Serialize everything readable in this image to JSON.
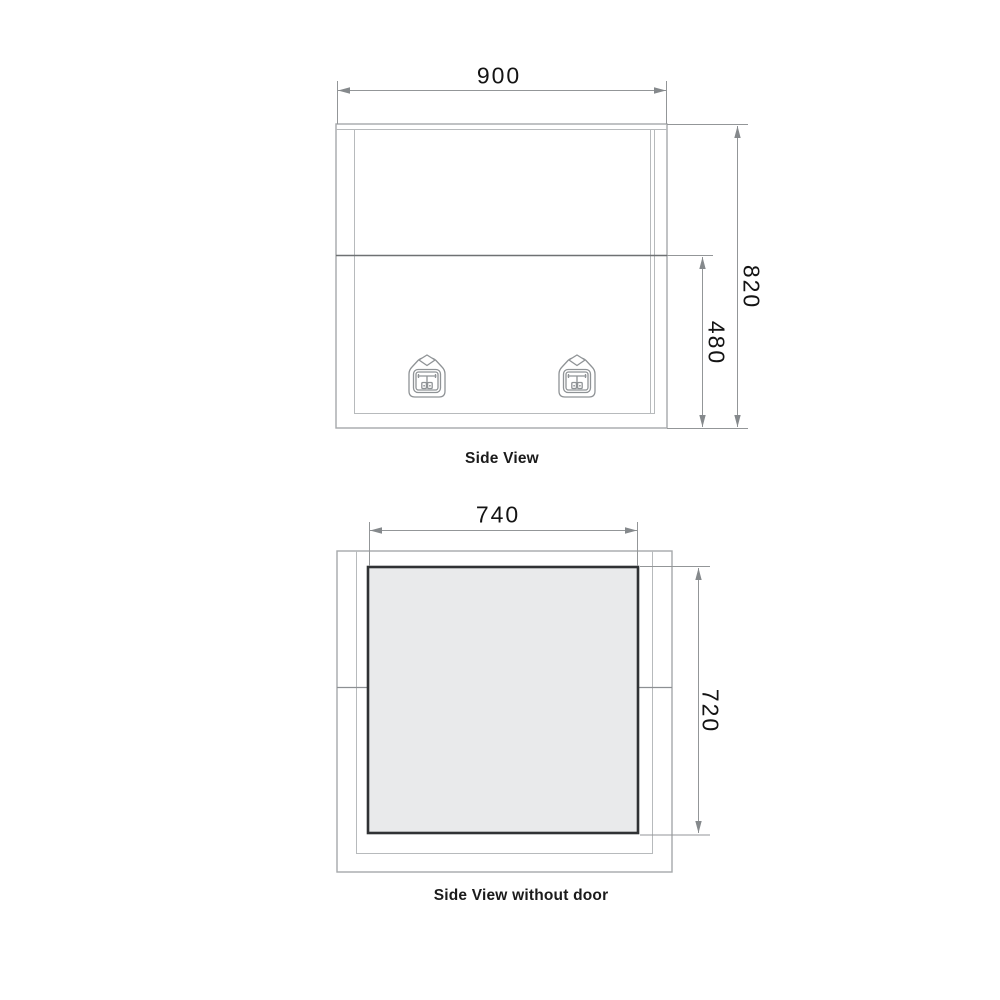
{
  "page": {
    "background_color": "#ffffff",
    "content_type": "technical-drawing"
  },
  "views": {
    "side_view": {
      "caption": "Side View",
      "dim_width": "900",
      "dim_height": "820",
      "dim_door_height": "480",
      "icons": [
        "latch-icon",
        "latch-icon"
      ]
    },
    "side_view_no_door": {
      "caption": "Side View without door",
      "dim_opening_width": "740",
      "dim_opening_height": "720"
    }
  },
  "colors": {
    "box_outline": "#a6a9ab",
    "inner_outline": "#b7babc",
    "door_seam": "#6e7173",
    "dimension_line": "#939698",
    "arrow": "#85898c",
    "opening_border": "#303234",
    "opening_fill": "#e9eaeb",
    "text": "#141414"
  }
}
